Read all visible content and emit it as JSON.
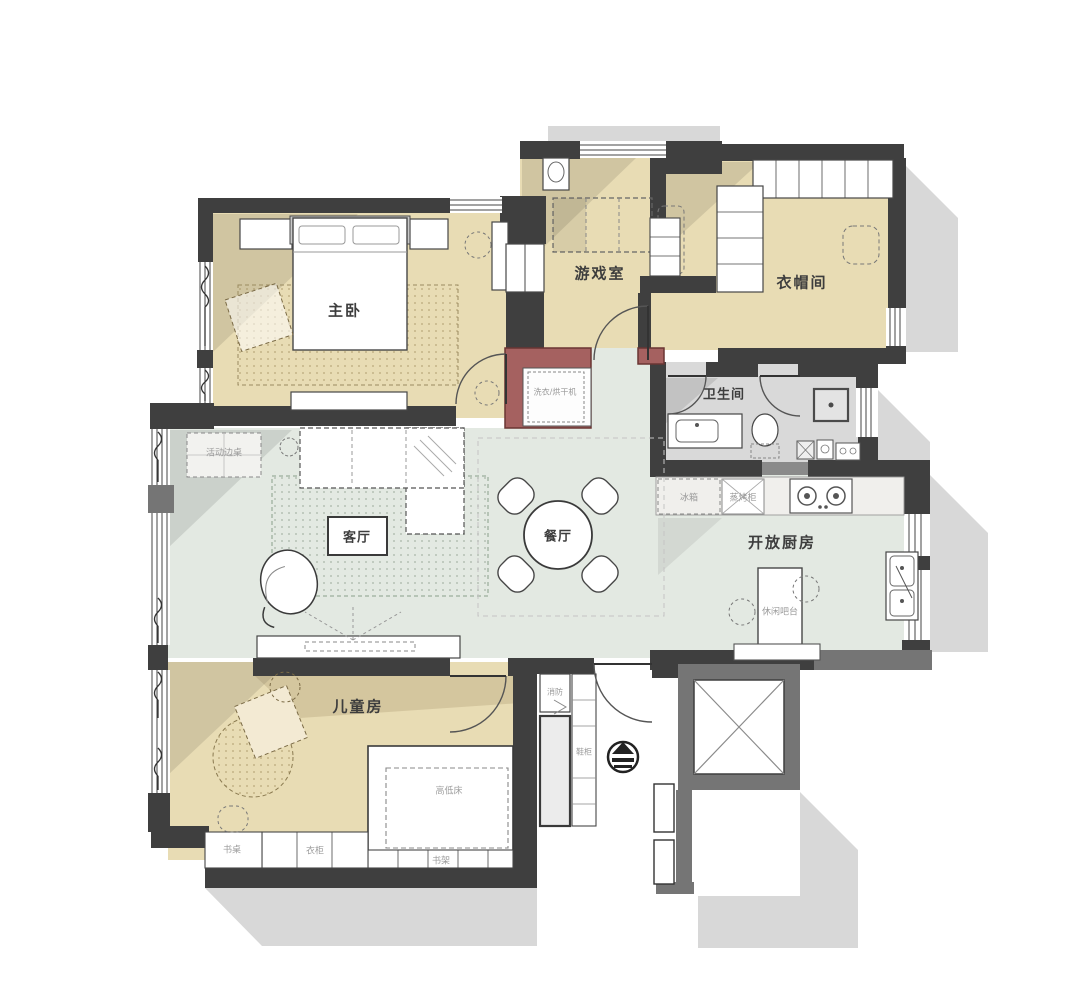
{
  "plan": {
    "rooms": {
      "master_bedroom": "主卧",
      "game_room": "游戏室",
      "cloakroom": "衣帽间",
      "bathroom": "卫生间",
      "living_room": "客厅",
      "dining_room": "餐厅",
      "open_kitchen": "开放厨房",
      "kids_room": "儿童房"
    },
    "fixtures": {
      "washer_dryer": "洗衣/烘干机",
      "fridge": "冰箱",
      "steam_oven": "蒸烤柜",
      "bar_counter": "休闲吧台",
      "side_table": "活动边桌",
      "bunk_bed": "高低床",
      "desk": "书桌",
      "wardrobe": "衣柜",
      "bookshelf": "书架",
      "fire_cabinet": "消防",
      "shoe_cabinet": "鞋柜"
    },
    "colors": {
      "wall": "#3f3f3f",
      "common_wall": "#757575",
      "bedroom_floor": "#e8dcb4",
      "living_floor": "#e3e9e2",
      "bath_floor": "#d9d9d9",
      "accent_wall": "#a56160",
      "shadow": "#d8d8d8"
    }
  }
}
